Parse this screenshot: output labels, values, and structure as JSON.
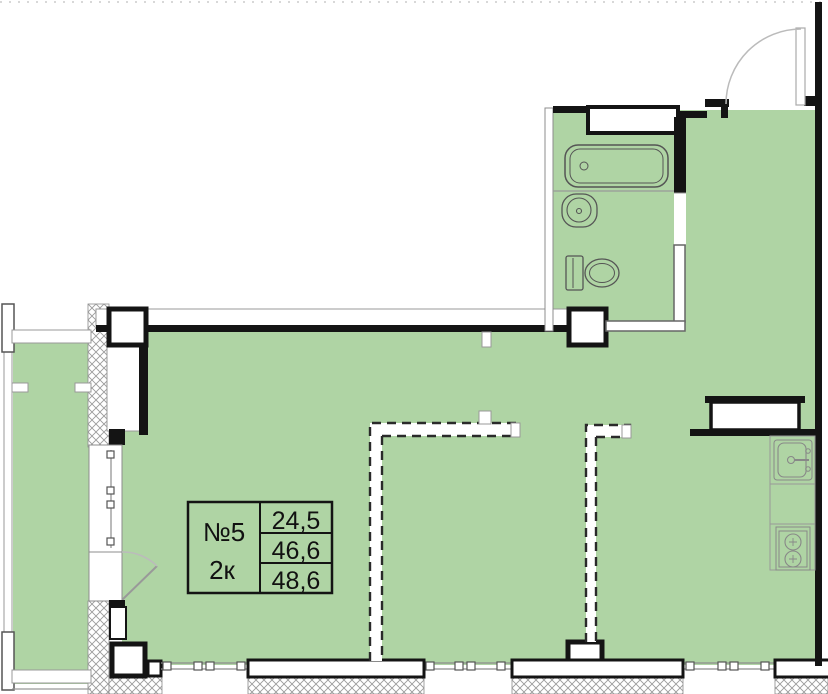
{
  "label_box": {
    "unit_number": "№5",
    "unit_type": "2к",
    "areas": [
      "24,5",
      "46,6",
      "48,6"
    ]
  },
  "colors": {
    "floor_fill": "#afd4a4",
    "wall_black": "#141414",
    "thin_line": "#8c8c8c",
    "partition_dash": "#2a2a2a",
    "hatch_line": "#9b9b9b"
  },
  "icons": {
    "bathtub": "rounded-rect-outline",
    "bathroom-sink": "circle-in-rounded-rect",
    "toilet": "tank-and-oval-bowl",
    "kitchen-sink": "square-basin-with-faucet",
    "stove": "two-burner-circles",
    "entrance-door": "leaf-with-quarter-arc",
    "balcony-door": "leaf-with-quarter-arc",
    "window": "double-line-with-handles",
    "insulation": "crosshatch"
  }
}
